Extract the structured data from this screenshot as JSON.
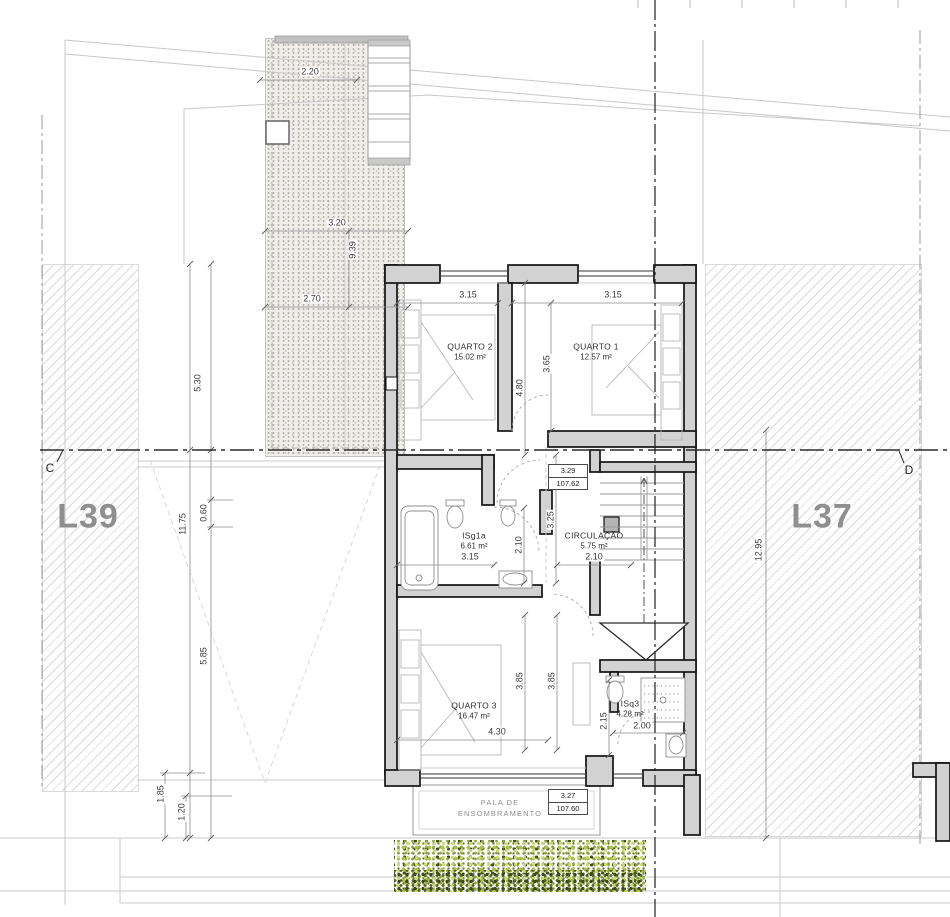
{
  "drawing": {
    "lot_left": "L39",
    "lot_right": "L37",
    "section_left": "C",
    "section_right": "D",
    "rooms": {
      "quarto2": {
        "name": "QUARTO 2",
        "area": "15.02 m²"
      },
      "quarto1": {
        "name": "QUARTO 1",
        "area": "12.57 m²"
      },
      "isg1a": {
        "name": "ISg1a",
        "area": "6.61 m²"
      },
      "circulacao": {
        "name": "CIRCULAÇÃO",
        "area": "5.75 m²"
      },
      "quarto3": {
        "name": "QUARTO 3",
        "area": "16.47 m²"
      },
      "isq3": {
        "name": "ISq3",
        "area": "4.28 m²"
      }
    },
    "levels": {
      "upper": {
        "value": "3.29",
        "elevation": "107.62"
      },
      "lower": {
        "value": "3.27",
        "elevation": "107.60"
      }
    },
    "pala": {
      "line1": "PALA DE",
      "line2": "ENSOMBRAMENTO"
    },
    "dims": {
      "terrace_w1": "2.20",
      "terrace_w2": "3.20",
      "terrace_h": "9.39",
      "terrace_w3": "2.70",
      "left_1": "5.30",
      "left_2": "11.75",
      "left_3": "0.60",
      "left_4": "5.85",
      "left_5": "1.85",
      "left_6": "1.20",
      "right_1": "12.95",
      "q2_w": "3.15",
      "q1_w": "3.15",
      "q2_h": "4.80",
      "q1_h": "3.65",
      "isg_w": "3.15",
      "isg_h": "2.10",
      "hall_h": "3.25",
      "circ_w": "2.10",
      "q3_w": "4.30",
      "q3_h_a": "3.85",
      "q3_h_b": "3.85",
      "isq3_h": "2.15",
      "isq3_w": "2.00"
    },
    "colors": {
      "wall_fill": "#d2d2d2",
      "hedge_light": "#b9cf57",
      "hedge_dark": "#44511f",
      "lot_label": "#8f8f8f"
    }
  }
}
